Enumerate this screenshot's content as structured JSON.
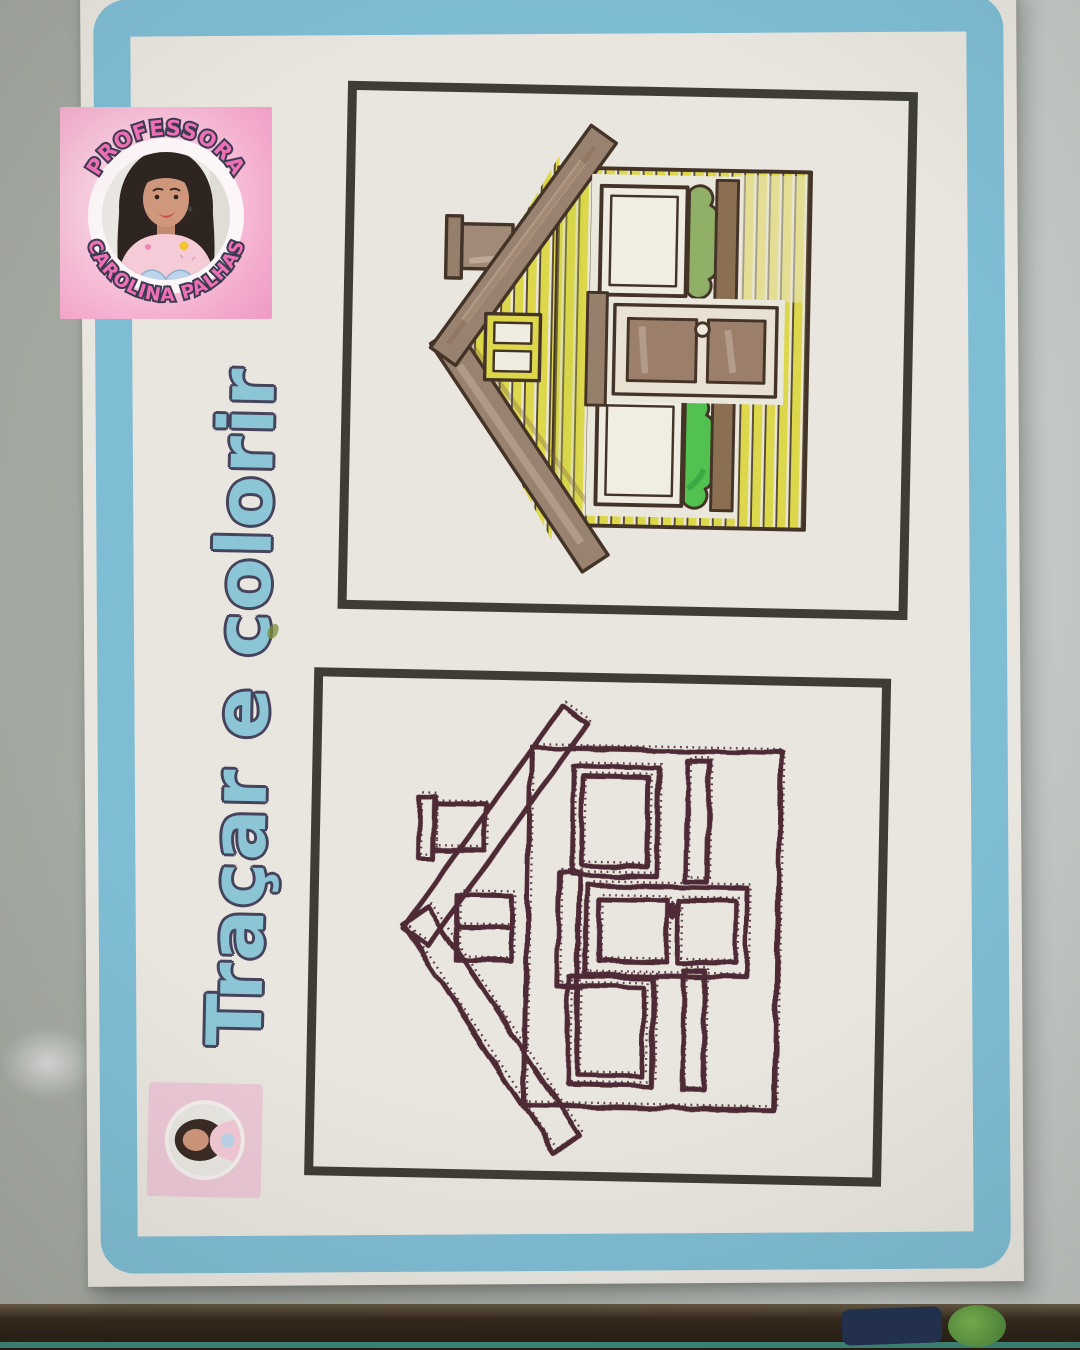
{
  "worksheet": {
    "title": "Traçar e colorir"
  },
  "badge": {
    "arc_top": "PROFESSORA",
    "arc_bottom": "CAROLINA PALHAS",
    "shirt_line1": "Educação",
    "shirt_line2": "Infantil"
  },
  "colors": {
    "paper": "#e9e6df",
    "frame_blue": "#7fbdd4",
    "box_frame": "#3f3c36",
    "title_fill": "#8cc6d6",
    "title_outline": "#45445c",
    "marker_trace": "#4e2a36",
    "house_yellow": "#ddd84b",
    "roof_brown": "#9a8270",
    "bush_green_bright": "#52c14f",
    "bush_green_olive": "#8fae66",
    "badge_pink_bg": "#f3a8cc",
    "arc_text_pink": "#f070b6",
    "arc_text_outline": "#3c3b52",
    "wall_gray": "#a7aca5"
  }
}
